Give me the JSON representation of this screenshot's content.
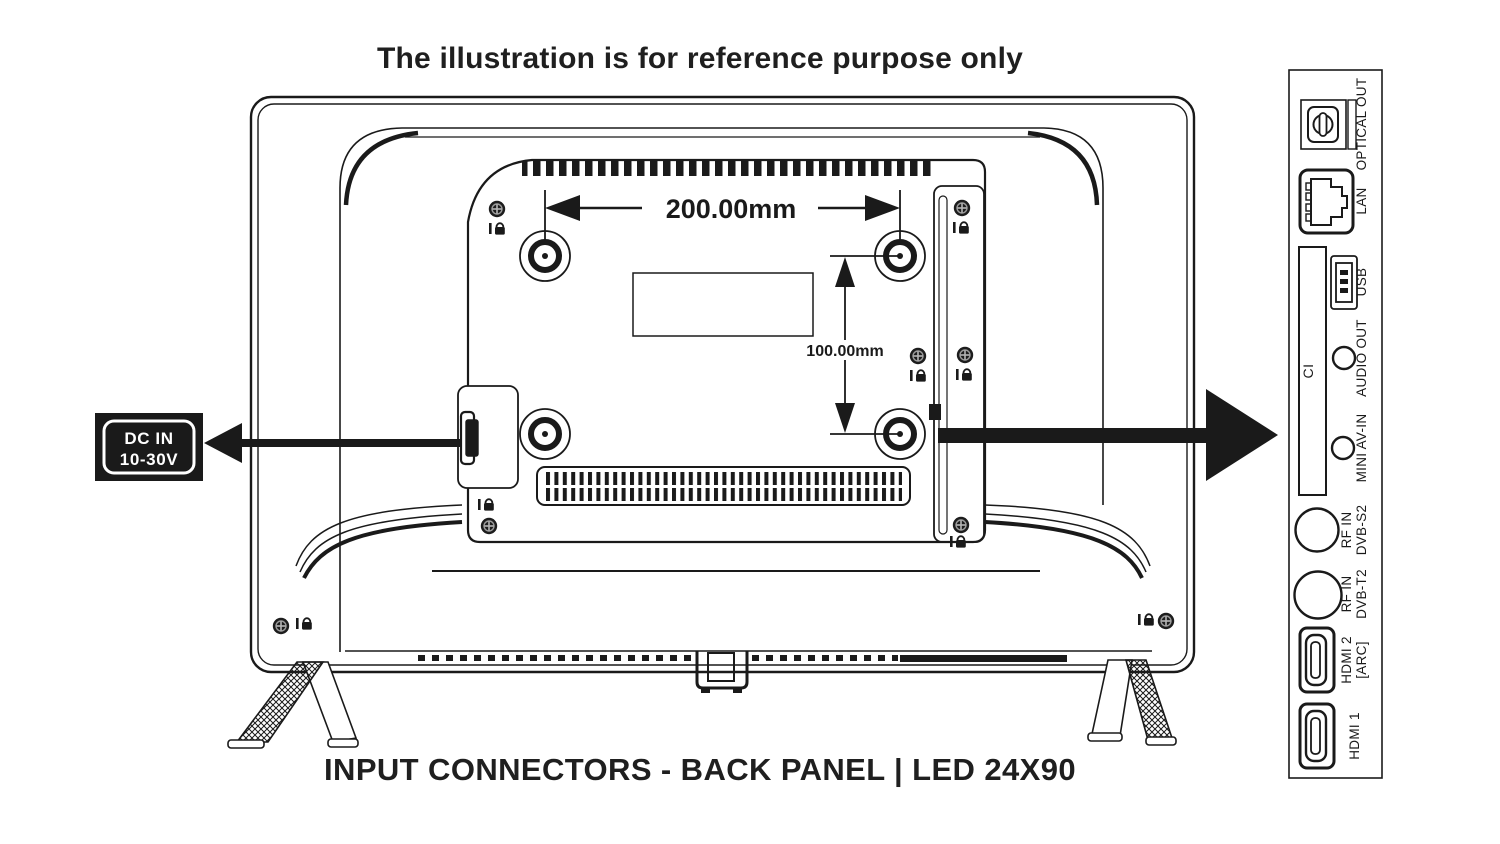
{
  "title": "The illustration is for reference purpose only",
  "caption": "INPUT CONNECTORS - BACK PANEL | LED 24X90",
  "dc_label": {
    "line1": "DC IN",
    "line2": "10-30V"
  },
  "dimensions": {
    "horizontal": "200.00mm",
    "vertical": "100.00mm"
  },
  "panel": {
    "optical_out": "OPTICAL OUT",
    "lan": "LAN",
    "usb": "USB",
    "ci": "CI",
    "audio_out": "AUDIO OUT",
    "mini_av_in": "MINI AV-IN",
    "rf_s2_1": "RF IN",
    "rf_s2_2": "DVB-S2",
    "rf_t2_1": "RF IN",
    "rf_t2_2": "DVB-T2",
    "hdmi2_1": "HDMI 2",
    "hdmi2_2": "[ARC]",
    "hdmi1": "HDMI 1"
  },
  "colors": {
    "ink": "#1a1a1a",
    "background": "#ffffff"
  }
}
